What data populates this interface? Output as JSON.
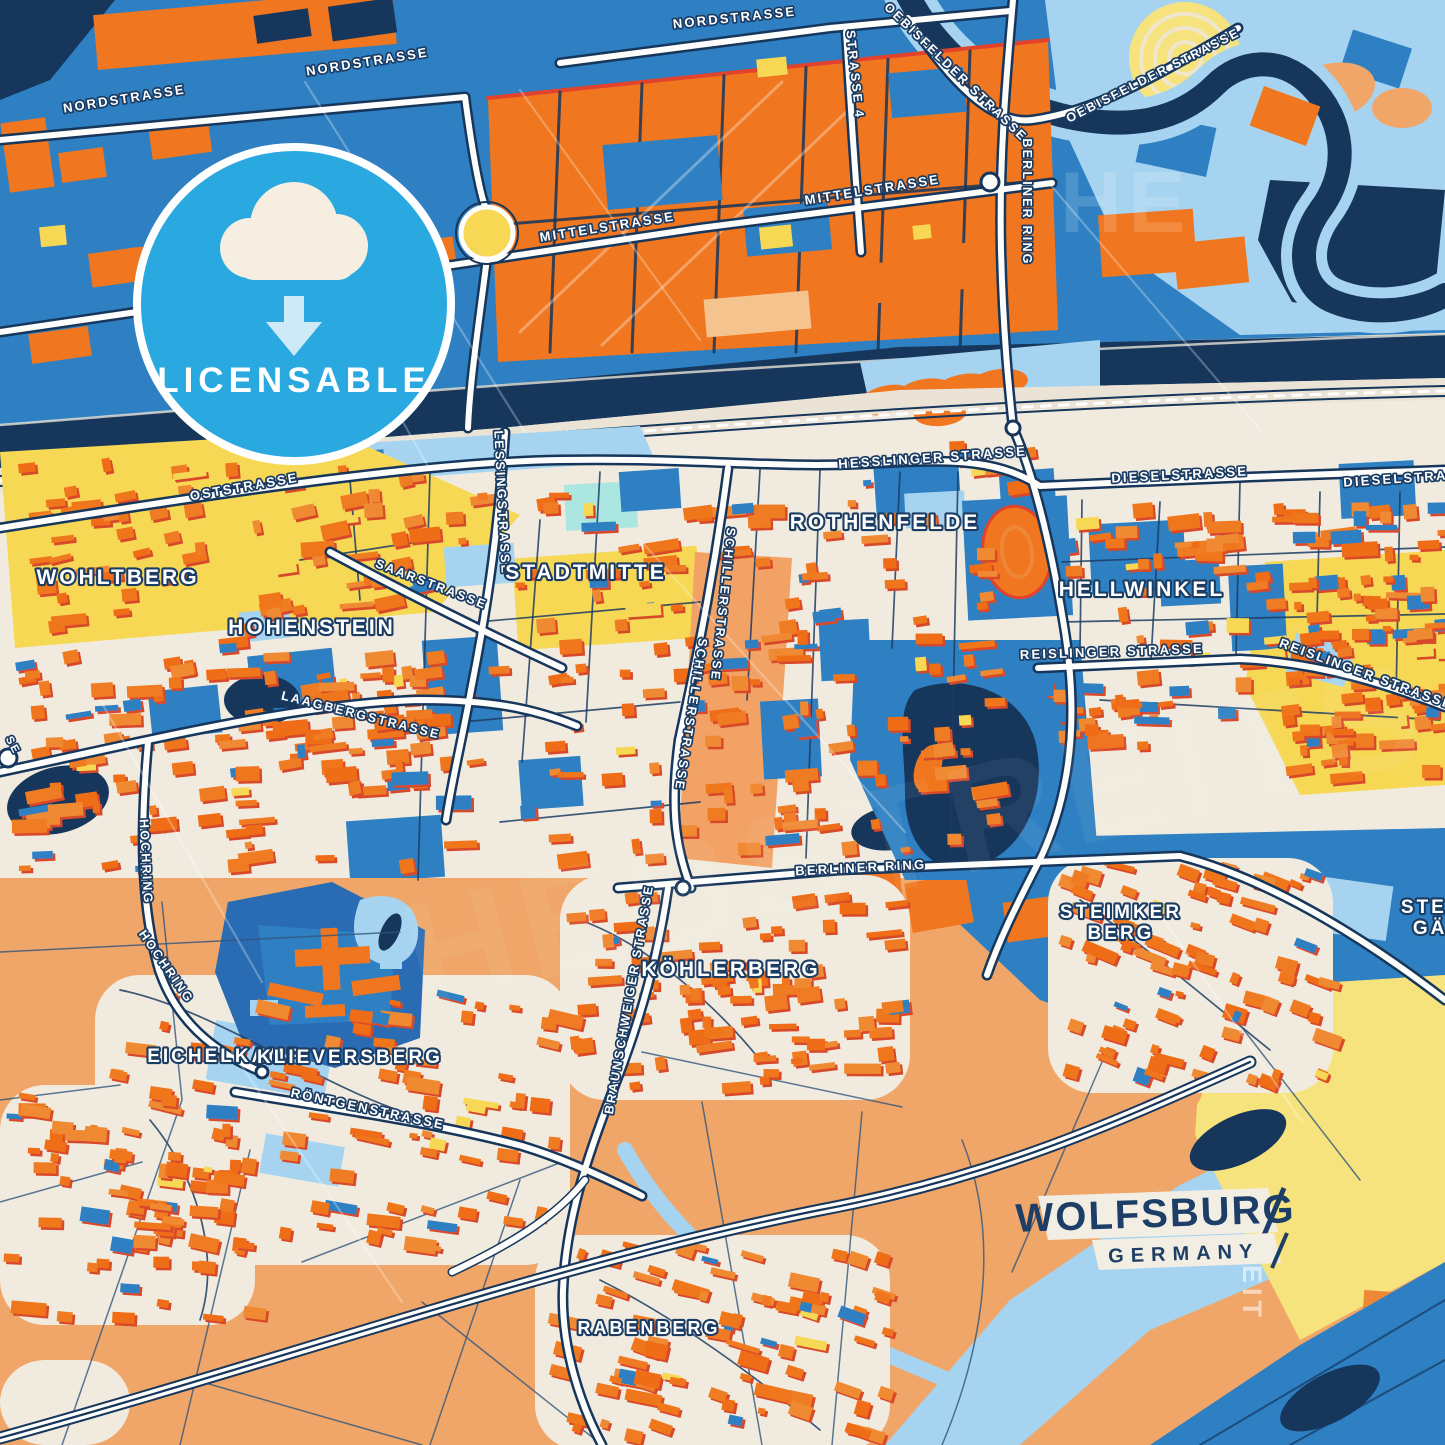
{
  "poster": {
    "city": "WOLFSBURG",
    "country": "GERMANY",
    "badge_label": "LICENSABLE",
    "badge_icon": "cloud-download-icon",
    "watermark": "HEBSTREITS",
    "watermark_fragment_h": "HE",
    "watermark_fragment_v": "STREIT"
  },
  "colors": {
    "navy": "#16365c",
    "blue": "#2e80c3",
    "blue2": "#2a6cb3",
    "lightblue": "#a6d4f0",
    "paleblue": "#c6e3f7",
    "aqua": "#abe6e0",
    "orange": "#f0761f",
    "orange2": "#ee8836",
    "peach": "#f0a668",
    "cream": "#f1ebdf",
    "cream2": "#ebe4d6",
    "yellow": "#f6d855",
    "paleyellow": "#f7e37e",
    "red": "#e2432c",
    "badge_blue": "#2aa9e1",
    "road_white": "#fdfdfb",
    "label_halo": "#1b3c63"
  },
  "street_labels": [
    {
      "text": "NORDSTRASSE",
      "x": 125,
      "y": 103,
      "rot": -9,
      "size": 13
    },
    {
      "text": "NORDSTRASSE",
      "x": 368,
      "y": 66,
      "rot": -9,
      "size": 13
    },
    {
      "text": "NORDSTRASSE",
      "x": 735,
      "y": 22,
      "rot": -6,
      "size": 13
    },
    {
      "text": "MITTELSTRASSE",
      "x": 330,
      "y": 277,
      "rot": -9,
      "size": 13
    },
    {
      "text": "MITTELSTRASSE",
      "x": 608,
      "y": 231,
      "rot": -9,
      "size": 13
    },
    {
      "text": "MITTELSTRASSE",
      "x": 873,
      "y": 194,
      "rot": -9,
      "size": 13
    },
    {
      "text": "STRASSE 4",
      "x": 851,
      "y": 75,
      "rot": 84,
      "size": 12.5
    },
    {
      "text": "OEBISFELDER STRASSE",
      "x": 953,
      "y": 75,
      "rot": 44,
      "size": 12.5
    },
    {
      "text": "OEBISFELDER STRASSE",
      "x": 1155,
      "y": 79,
      "rot": -27,
      "size": 12.5
    },
    {
      "text": "BERLINER RING",
      "x": 1023,
      "y": 202,
      "rot": 90,
      "size": 12.5
    },
    {
      "text": "OSTSTRASSE",
      "x": 245,
      "y": 491,
      "rot": -10,
      "size": 13
    },
    {
      "text": "HESSLINGER STRASSE",
      "x": 933,
      "y": 462,
      "rot": -4,
      "size": 13
    },
    {
      "text": "DIESELSTRASSE",
      "x": 1180,
      "y": 479,
      "rot": -3,
      "size": 13
    },
    {
      "text": "DIESELSTRASSE",
      "x": 1412,
      "y": 482,
      "rot": -4,
      "size": 13
    },
    {
      "text": "LESSINGSTRASSE",
      "x": 498,
      "y": 503,
      "rot": 87,
      "size": 12.5
    },
    {
      "text": "SAARSTRASSE",
      "x": 430,
      "y": 588,
      "rot": 21,
      "size": 12.5
    },
    {
      "text": "REISLINGER STRASSE",
      "x": 1112,
      "y": 656,
      "rot": -2,
      "size": 13
    },
    {
      "text": "REISLINGER STRASSE",
      "x": 1365,
      "y": 678,
      "rot": 20,
      "size": 13
    },
    {
      "text": "LAAGBERGSTRASSE",
      "x": 360,
      "y": 719,
      "rot": 14,
      "size": 12.5
    },
    {
      "text": "SCHILLERSTRASSE",
      "x": 719,
      "y": 604,
      "rot": 96,
      "size": 12.5
    },
    {
      "text": "SCHILLERSTRASSE",
      "x": 687,
      "y": 714,
      "rot": 99,
      "size": 12.5
    },
    {
      "text": "BERLINER RING",
      "x": 861,
      "y": 872,
      "rot": -3,
      "size": 13
    },
    {
      "text": "HOCHRING",
      "x": 142,
      "y": 862,
      "rot": 87,
      "size": 12.5
    },
    {
      "text": "HOCHRING",
      "x": 163,
      "y": 969,
      "rot": 55,
      "size": 12.5
    },
    {
      "text": "BRAUNSCHWEIGER STRASSE",
      "x": 633,
      "y": 1000,
      "rot": -80,
      "size": 12.5
    },
    {
      "text": "RÖNTGENSTRASSE",
      "x": 367,
      "y": 1113,
      "rot": 12,
      "size": 13
    },
    {
      "text": "SE",
      "x": 10,
      "y": 747,
      "rot": 62,
      "size": 11
    }
  ],
  "district_labels": [
    {
      "text": "WOHLTBERG",
      "x": 118,
      "y": 584,
      "size": 21
    },
    {
      "text": "HOHENSTEIN",
      "x": 312,
      "y": 634,
      "size": 21
    },
    {
      "text": "STADTMITTE",
      "x": 586,
      "y": 579,
      "size": 21
    },
    {
      "text": "ROTHENFELDE",
      "x": 885,
      "y": 529,
      "size": 21
    },
    {
      "text": "HELLWINKEL",
      "x": 1142,
      "y": 596,
      "size": 21
    },
    {
      "text": "KÖHLERBERG",
      "x": 731,
      "y": 976,
      "size": 21
    },
    {
      "text": "EICHELKAMP",
      "x": 225,
      "y": 1062,
      "size": 19
    },
    {
      "text": "KLIEVERSBERG",
      "x": 350,
      "y": 1063,
      "size": 19
    },
    {
      "text": "RABENBERG",
      "x": 649,
      "y": 1334,
      "size": 18
    },
    {
      "text": "STEIMKER BERG",
      "lines": [
        "STEIMKER",
        "BERG"
      ],
      "x": 1121,
      "y": 918,
      "size": 19
    },
    {
      "text": "STEIMKER GÄRTEN",
      "lines": [
        "STEIMKER",
        "GÄRTEN"
      ],
      "x": 1462,
      "y": 913,
      "size": 19
    }
  ]
}
